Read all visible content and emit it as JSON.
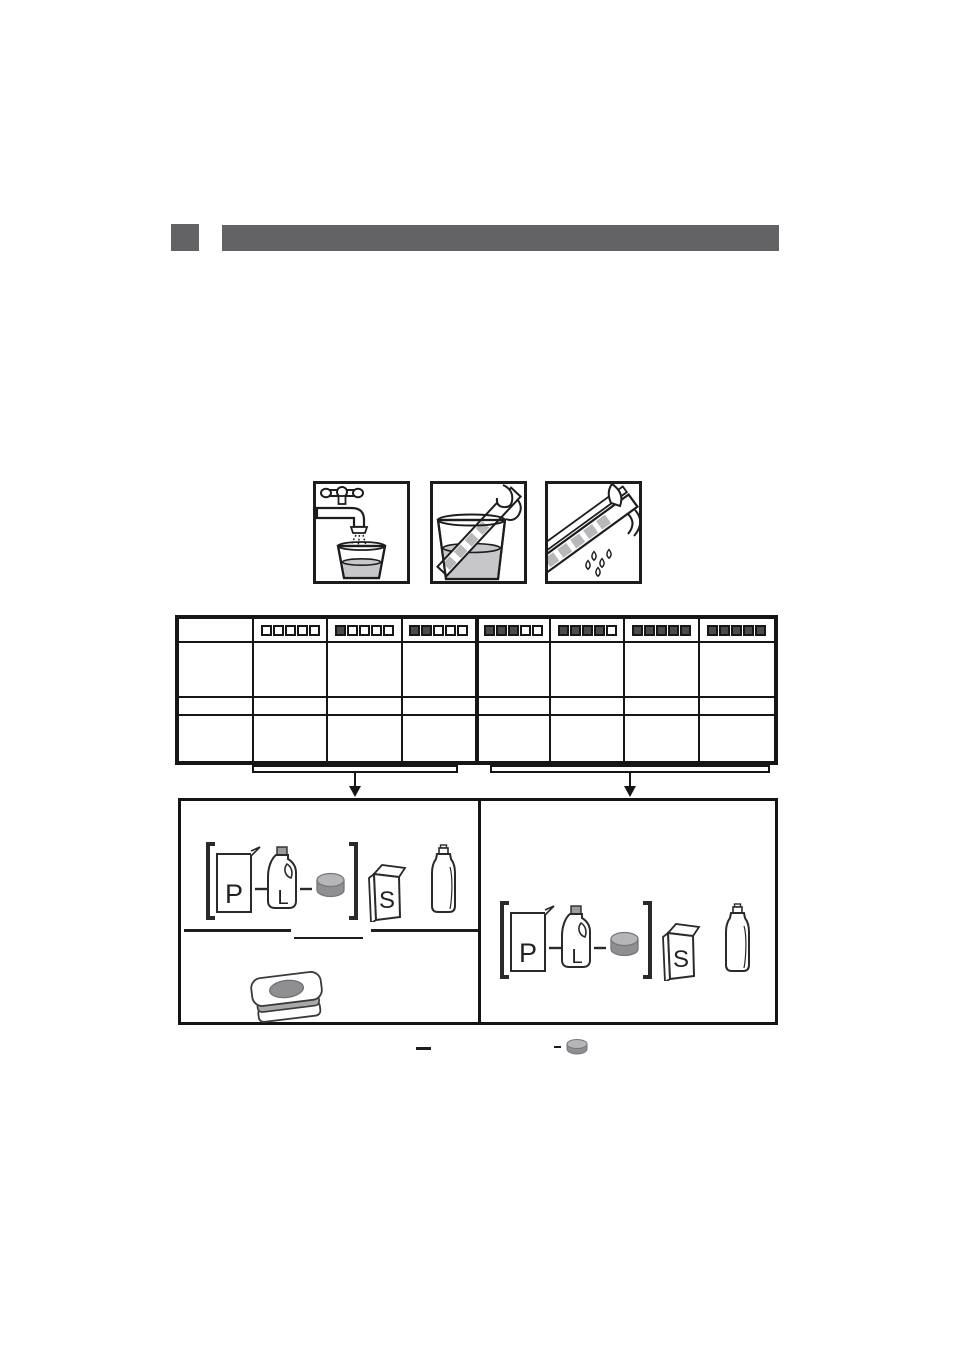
{
  "document": {
    "type": "appliance-manual-page-graphics-only",
    "ink_color": "#161616",
    "background": "#ffffff"
  },
  "section_header": {
    "marker_color": "#636366",
    "bar_color": "#636366",
    "title_text": ""
  },
  "instruction_steps": [
    {
      "icon": "tap-filling-glass-icon"
    },
    {
      "icon": "test-strip-dipped-in-glass-icon"
    },
    {
      "icon": "test-strip-shake-dry-icon"
    }
  ],
  "hardness_table": {
    "strip_squares_per_pattern": 5,
    "strip_filled_counts": [
      0,
      1,
      2,
      3,
      4,
      5,
      5
    ],
    "strip_fill_color": "#4b4b4d",
    "body_row_count": 3,
    "column_count": 8,
    "thick_divider_before_column": 4,
    "left_group_patterns": [
      0,
      1,
      2
    ],
    "right_group_patterns": [
      3,
      4,
      5,
      6
    ]
  },
  "result_groups": {
    "left": {
      "powder_label": "P",
      "liquid_label": "L",
      "salt_label": "S"
    },
    "right": {
      "powder_label": "P",
      "liquid_label": "L",
      "salt_label": "S"
    }
  },
  "legend": {
    "dash_symbol": "—",
    "tablet_dash": "–"
  },
  "palette": {
    "water_gray": "#c7c7c9",
    "strip_square_gray": "#b8b8ba",
    "tablet_top": "#b6b6b8",
    "tablet_body": "#8f8f91",
    "layer_stripe": "#a9a9ab",
    "cap_gray": "#9b9b9d"
  }
}
